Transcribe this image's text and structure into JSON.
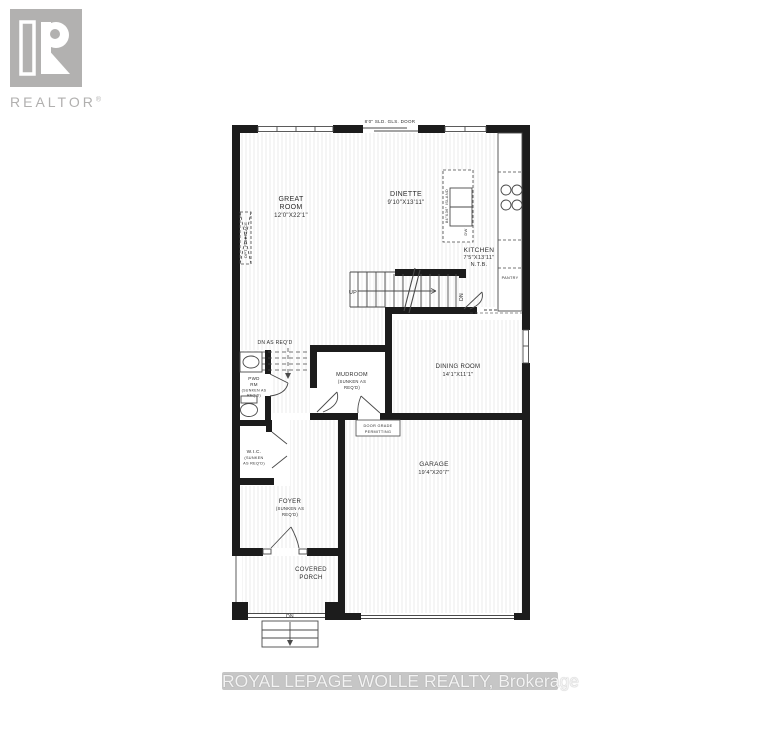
{
  "logo": {
    "text": "REALTOR",
    "reg": "®",
    "color": "#b1b0af"
  },
  "watermark": {
    "text": "ROYAL LEPAGE WOLLE REALTY, Brokerage"
  },
  "plan": {
    "colors": {
      "wall": "#1c1c1c",
      "line": "#4a4a4a",
      "hatch": "#ebebeb",
      "text": "#2d2d2d"
    },
    "top_note": "8'0\" SLD. GLS. DOOR",
    "rooms": {
      "great_room": {
        "lines": [
          "GREAT",
          "ROOM",
          "12'0\"X22'1\""
        ]
      },
      "dinette": {
        "lines": [
          "DINETTE",
          "9'10\"X13'11\""
        ]
      },
      "kitchen": {
        "lines": [
          "KITCHEN",
          "7'5\"X13'11\"",
          "N.T.B."
        ]
      },
      "dining_room": {
        "lines": [
          "DINING ROOM",
          "14'1\"X11'1\""
        ]
      },
      "mudroom": {
        "lines": [
          "MUDROOM",
          "(SUNKEN AS",
          "REQ'D)"
        ]
      },
      "pwd_rm": {
        "lines": [
          "PWD",
          "RM",
          "(SUNKEN AS",
          "REQ'D)"
        ]
      },
      "wic": {
        "lines": [
          "W.I.C.",
          "(SUNKEN",
          "AS REQ'D)"
        ]
      },
      "foyer": {
        "lines": [
          "FOYER",
          "(SUNKEN AS",
          "REQ'D)"
        ]
      },
      "garage": {
        "lines": [
          "GARAGE",
          "19'4\"X20'7\""
        ]
      },
      "covered_porch": {
        "lines": [
          "COVERED",
          "PORCH"
        ]
      },
      "pantry": {
        "label": "PANTRY"
      }
    },
    "annotations": {
      "up": "UP",
      "dn_stairs": "DN",
      "dn_porch": "DN",
      "dn_as_reqd": "DN AS REQ'D",
      "opt_fireplace": "OPT. FIREPLACE",
      "island": "84\"X36\" ISLAND",
      "dw": "DW",
      "door_grade": {
        "lines": [
          "DOOR GRADE",
          "PERMITTING"
        ]
      }
    }
  }
}
